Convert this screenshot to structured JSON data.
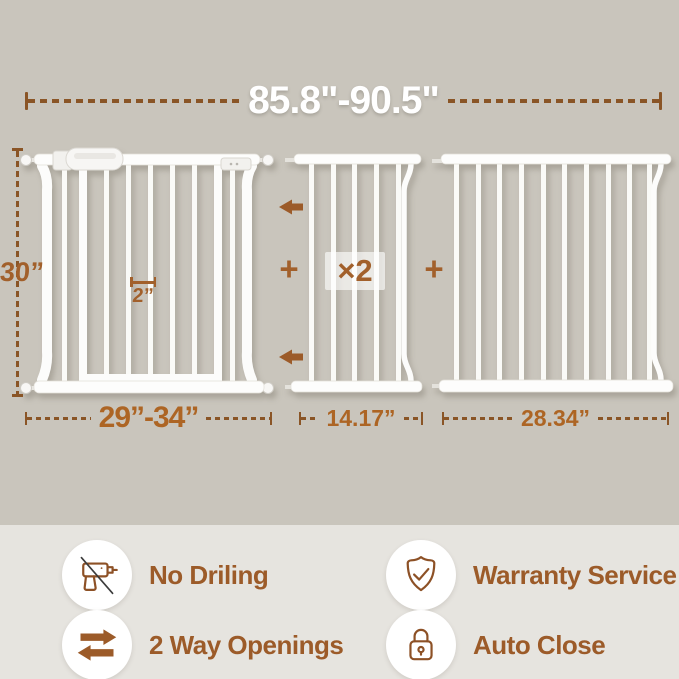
{
  "palette": {
    "background_top": "#c9c5bc",
    "background_bottom": "#e6e4df",
    "dimension_line_brown": "#8a5526",
    "accent_brown": "#a2602b",
    "bottom_dimension_text": "#ad6524",
    "feature_text": "#9c5b29",
    "gate_white": "#fcfcfb",
    "top_dimension_text": "#ffffff"
  },
  "dimensions": {
    "total_width": {
      "label": "85.8\"-90.5\""
    },
    "gate_height": {
      "label": "30”"
    },
    "bar_gap": {
      "label": "2”"
    }
  },
  "panels": [
    {
      "id": "main-gate",
      "width_label": "29”-34”"
    },
    {
      "id": "extension-panel-small",
      "width_label": "14.17”",
      "multiplier": "×2"
    },
    {
      "id": "extension-panel-large",
      "width_label": "28.34”"
    }
  ],
  "assembly": {
    "plus_left": "+",
    "plus_right": "+"
  },
  "features": [
    {
      "icon": "no-drill-icon",
      "label": "No Driling"
    },
    {
      "icon": "two-way-openings-icon",
      "label": "2 Way Openings"
    },
    {
      "icon": "warranty-shield-icon",
      "label": "Warranty Service"
    },
    {
      "icon": "auto-close-lock-icon",
      "label": "Auto Close"
    }
  ]
}
